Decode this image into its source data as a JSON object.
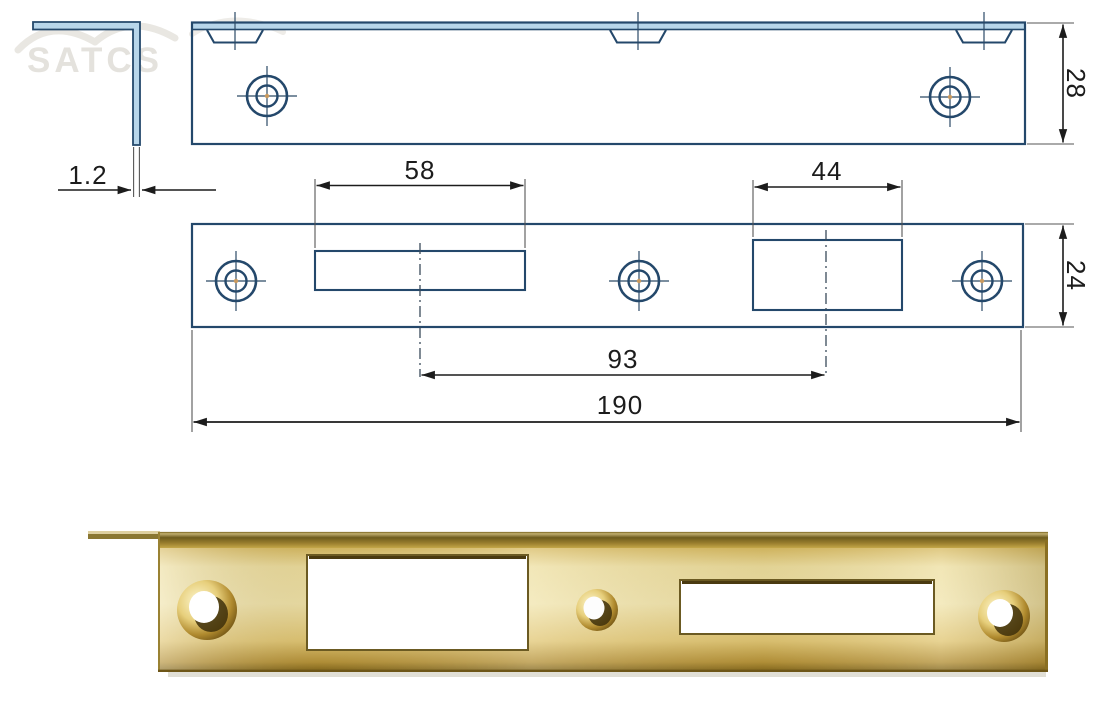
{
  "watermark": {
    "text": "SATCS"
  },
  "drawing": {
    "dimensions": {
      "thickness": "1.2",
      "upper_plate_width": "28",
      "latch_cutout_length": "58",
      "deadbolt_cutout_length": "44",
      "lower_plate_width": "24",
      "cutout_center_distance": "93",
      "overall_length": "190"
    }
  },
  "colors": {
    "outline_blue": "#24486b",
    "lip_fill_blue": "#b8d6ea",
    "dimension_ink": "#1c1c1c",
    "watermark_gray": "#e4e2dd",
    "brass_light": "#f3e7b2",
    "brass_mid": "#d9b95a",
    "brass_dark": "#7a6018"
  }
}
